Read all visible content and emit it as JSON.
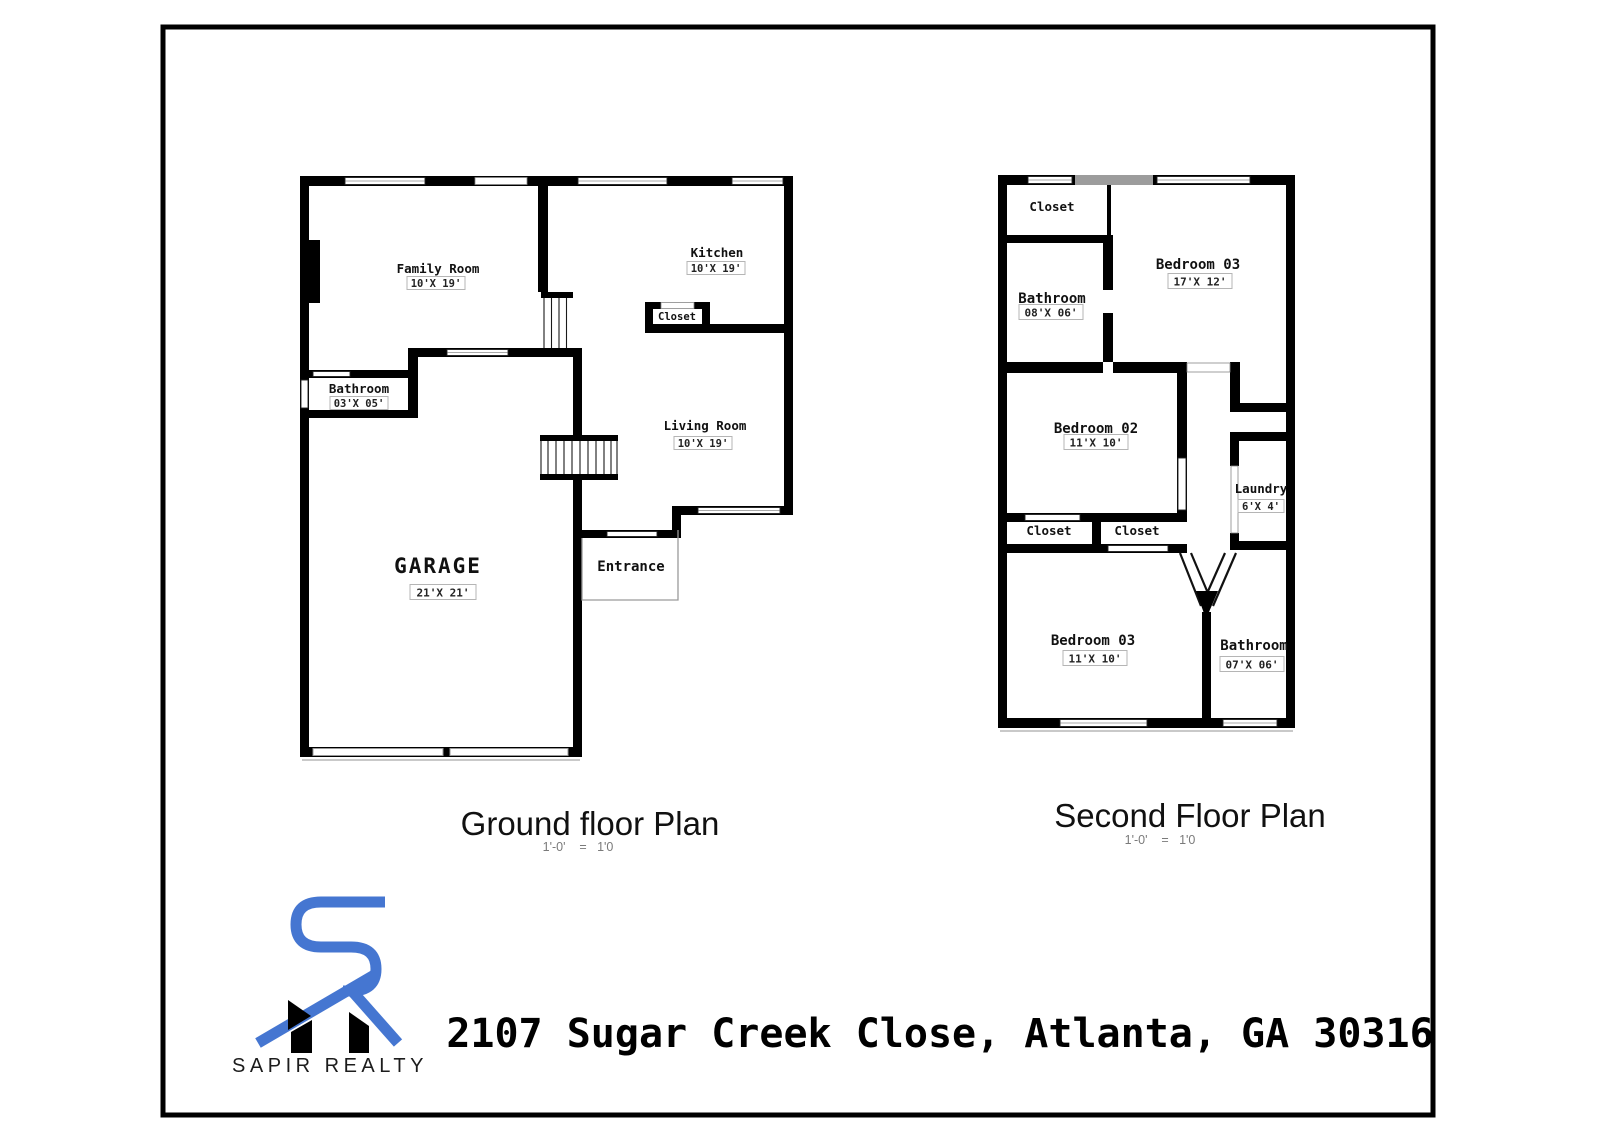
{
  "frame": {
    "border_color": "#000000"
  },
  "ground_floor": {
    "title": "Ground floor Plan",
    "scale_note": "1'-0'    =   1'0",
    "rooms": {
      "family": {
        "name": "Family Room",
        "dims": "10'X 19'"
      },
      "kitchen": {
        "name": "Kitchen",
        "dims": "10'X 19'"
      },
      "closet": {
        "name": "Closet"
      },
      "bathroom": {
        "name": "Bathroom",
        "dims": "03'X 05'"
      },
      "living": {
        "name": "Living Room",
        "dims": "10'X 19'"
      },
      "garage": {
        "name": "GARAGE",
        "dims": "21'X 21'"
      },
      "entrance": {
        "name": "Entrance"
      }
    }
  },
  "second_floor": {
    "title": "Second Floor Plan",
    "scale_note": "1'-0'    =   1'0",
    "rooms": {
      "closet_top": {
        "name": "Closet"
      },
      "bathroom_top": {
        "name": "Bathroom",
        "dims": "08'X 06'"
      },
      "bedroom3a": {
        "name": "Bedroom 03",
        "dims": "17'X 12'"
      },
      "bedroom2": {
        "name": "Bedroom 02",
        "dims": "11'X 10'"
      },
      "laundry": {
        "name": "Laundry",
        "dims": "6'X 4'"
      },
      "closet_left": {
        "name": "Closet"
      },
      "closet_right": {
        "name": "Closet"
      },
      "bedroom3b": {
        "name": "Bedroom 03",
        "dims": "11'X 10'"
      },
      "bathroom_bottom": {
        "name": "Bathroom",
        "dims": "07'X 06'"
      }
    }
  },
  "branding": {
    "company": "SAPIR REALTY",
    "accent_blue": "#4576d1"
  },
  "address": "2107 Sugar Creek Close, Atlanta, GA 30316"
}
